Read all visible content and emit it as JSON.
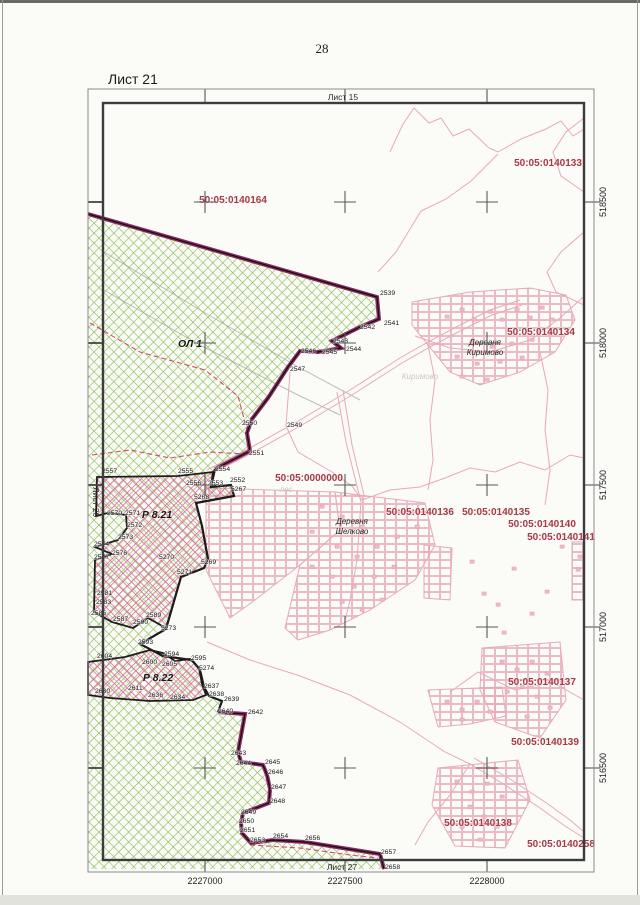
{
  "page": {
    "number": "28",
    "sheet_title": "Лист 21"
  },
  "frame": {
    "top_label": "Лист 15",
    "left_label": "Лист 20",
    "bottom_label": "Лист 27"
  },
  "colors": {
    "cadastral_red": "#a63a45",
    "topo_pink": "#e8a9b8",
    "building_pink": "#efb9c8",
    "green_hatch": "#86bb50",
    "maroon_border": "#8c2862",
    "pink_zone": "#dd5f9b",
    "black_border": "#1c1c1c",
    "gray_line": "#bdbdbd",
    "dash_red": "#d8486e"
  },
  "grid": {
    "x_labels": [
      {
        "text": "2227000",
        "x": 205
      },
      {
        "text": "2227500",
        "x": 345
      },
      {
        "text": "2228000",
        "x": 487
      }
    ],
    "y_labels": [
      {
        "text": "518500",
        "y": 202
      },
      {
        "text": "518000",
        "y": 343
      },
      {
        "text": "517500",
        "y": 485
      },
      {
        "text": "517000",
        "y": 627
      },
      {
        "text": "516500",
        "y": 768
      }
    ],
    "cross_xs": [
      205,
      345,
      487
    ],
    "cross_ys": [
      202,
      343,
      485,
      627,
      768
    ]
  },
  "cadastral_labels": [
    {
      "text": "50:05:0140133",
      "x": 548,
      "y": 166
    },
    {
      "text": "50:05:0140164",
      "x": 233,
      "y": 203
    },
    {
      "text": "50:05:0140134",
      "x": 541,
      "y": 335
    },
    {
      "text": "50:05:0000000",
      "x": 309,
      "y": 481
    },
    {
      "text": "50:05:0140136",
      "x": 420,
      "y": 515
    },
    {
      "text": "50:05:0140135",
      "x": 496,
      "y": 515
    },
    {
      "text": "50:05:0140140",
      "x": 542,
      "y": 527
    },
    {
      "text": "50:05:0140141",
      "x": 561,
      "y": 540
    },
    {
      "text": "50:05:0140137",
      "x": 542,
      "y": 685
    },
    {
      "text": "50:05:0140139",
      "x": 545,
      "y": 745
    },
    {
      "text": "50:05:0140138",
      "x": 478,
      "y": 826
    },
    {
      "text": "50:05:0140258",
      "x": 561,
      "y": 847
    }
  ],
  "village_labels": [
    {
      "line1": "Деревня",
      "line2": "Киримово",
      "x": 485,
      "y": 345
    },
    {
      "line1": "Деревня",
      "line2": "Шелково",
      "x": 352,
      "y": 524
    }
  ],
  "ghost_labels": [
    {
      "text": "Киримово",
      "x": 420,
      "y": 379
    },
    {
      "text": "лес",
      "x": 286,
      "y": 492
    }
  ],
  "zone_labels": [
    {
      "text": "ОЛ 1",
      "x": 190,
      "y": 347
    },
    {
      "text": "Р 8.21",
      "x": 157,
      "y": 518
    },
    {
      "text": "Р 8.22",
      "x": 158,
      "y": 681
    }
  ],
  "points": [
    {
      "n": "2539",
      "x": 380,
      "y": 295
    },
    {
      "n": "2541",
      "x": 384,
      "y": 325
    },
    {
      "n": "2542",
      "x": 360,
      "y": 329
    },
    {
      "n": "2543",
      "x": 333,
      "y": 343
    },
    {
      "n": "2544",
      "x": 346,
      "y": 351
    },
    {
      "n": "2545",
      "x": 322,
      "y": 354
    },
    {
      "n": "2546",
      "x": 301,
      "y": 353
    },
    {
      "n": "2547",
      "x": 290,
      "y": 371
    },
    {
      "n": "2550",
      "x": 242,
      "y": 425
    },
    {
      "n": "2549",
      "x": 287,
      "y": 427
    },
    {
      "n": "2551",
      "x": 249,
      "y": 455
    },
    {
      "n": "2557",
      "x": 102,
      "y": 473
    },
    {
      "n": "2555",
      "x": 178,
      "y": 473
    },
    {
      "n": "2554",
      "x": 215,
      "y": 471
    },
    {
      "n": "2556",
      "x": 186,
      "y": 485
    },
    {
      "n": "2553",
      "x": 208,
      "y": 485
    },
    {
      "n": "2552",
      "x": 230,
      "y": 482
    },
    {
      "n": "5267",
      "x": 231,
      "y": 491
    },
    {
      "n": "5268",
      "x": 194,
      "y": 499
    },
    {
      "n": "2570",
      "x": 107,
      "y": 515
    },
    {
      "n": "2571",
      "x": 125,
      "y": 515
    },
    {
      "n": "2572",
      "x": 127,
      "y": 527
    },
    {
      "n": "2573",
      "x": 118,
      "y": 539
    },
    {
      "n": "2574",
      "x": 94,
      "y": 546
    },
    {
      "n": "2576",
      "x": 112,
      "y": 555
    },
    {
      "n": "2577",
      "x": 94,
      "y": 559
    },
    {
      "n": "5270",
      "x": 159,
      "y": 559
    },
    {
      "n": "5269",
      "x": 201,
      "y": 564
    },
    {
      "n": "5271",
      "x": 177,
      "y": 574
    },
    {
      "n": "2581",
      "x": 97,
      "y": 595
    },
    {
      "n": "2583",
      "x": 96,
      "y": 604
    },
    {
      "n": "2585",
      "x": 91,
      "y": 615
    },
    {
      "n": "2587",
      "x": 113,
      "y": 621
    },
    {
      "n": "2589",
      "x": 146,
      "y": 617
    },
    {
      "n": "2590",
      "x": 133,
      "y": 624
    },
    {
      "n": "5273",
      "x": 161,
      "y": 630
    },
    {
      "n": "2593",
      "x": 138,
      "y": 644
    },
    {
      "n": "2594",
      "x": 164,
      "y": 656
    },
    {
      "n": "2595",
      "x": 191,
      "y": 660
    },
    {
      "n": "5274",
      "x": 199,
      "y": 670
    },
    {
      "n": "2600",
      "x": 142,
      "y": 664
    },
    {
      "n": "2604",
      "x": 97,
      "y": 658
    },
    {
      "n": "2605",
      "x": 162,
      "y": 666
    },
    {
      "n": "2611",
      "x": 128,
      "y": 690
    },
    {
      "n": "2630",
      "x": 95,
      "y": 693
    },
    {
      "n": "2634",
      "x": 170,
      "y": 699
    },
    {
      "n": "2636",
      "x": 148,
      "y": 697
    },
    {
      "n": "2637",
      "x": 204,
      "y": 688
    },
    {
      "n": "2638",
      "x": 209,
      "y": 696
    },
    {
      "n": "2639",
      "x": 224,
      "y": 701
    },
    {
      "n": "2640",
      "x": 218,
      "y": 713
    },
    {
      "n": "2642",
      "x": 248,
      "y": 714
    },
    {
      "n": "2643",
      "x": 231,
      "y": 755
    },
    {
      "n": "2644",
      "x": 236,
      "y": 765
    },
    {
      "n": "2645",
      "x": 265,
      "y": 764
    },
    {
      "n": "2646",
      "x": 268,
      "y": 774
    },
    {
      "n": "2647",
      "x": 271,
      "y": 789
    },
    {
      "n": "2648",
      "x": 270,
      "y": 803
    },
    {
      "n": "2649",
      "x": 241,
      "y": 814
    },
    {
      "n": "2650",
      "x": 239,
      "y": 823
    },
    {
      "n": "2651",
      "x": 240,
      "y": 832
    },
    {
      "n": "2653",
      "x": 250,
      "y": 842
    },
    {
      "n": "2654",
      "x": 273,
      "y": 838
    },
    {
      "n": "2656",
      "x": 305,
      "y": 840
    },
    {
      "n": "2657",
      "x": 381,
      "y": 854
    },
    {
      "n": "2658",
      "x": 385,
      "y": 869
    }
  ],
  "map_shapes": {
    "green_area": "88,214 377,297 379,319 360,327 332,341 341,348 318,352 300,351 288,367 268,398 252,419 247,433 250,451 215,469 211,487 231,485 234,496 196,503 202,526 208,559 204,568 181,577 166,629 140,644 163,656 192,660 200,670 204,687 209,696 222,701 218,712 245,714 238,752 241,762 263,765 267,775 270,789 269,803 243,813 241,823 242,833 251,843 273,840 305,842 380,854 384,869 88,869",
    "maroon_border_1": "M88,214 L377,297 379,319 360,327 332,341 341,348 318,352 300,351 288,367 268,398 252,419 247,433 250,451 215,469",
    "maroon_border_2": "M218,712 L245,714 238,752 241,762 263,765 267,775 270,789 269,803 243,813 241,823 242,833 251,843 273,840 305,842 380,854 384,869",
    "black_border_mid": "M215,469 L211,487 231,485 234,496 196,503 202,526 208,559 204,568 181,577 166,629 140,644 163,656 192,660 200,670 204,687 209,696 222,701 218,712",
    "zone_821": "97,477 178,476 213,472 211,487 231,485 234,496 196,503 202,526 208,559 204,568 181,577 166,628 148,618 133,628 112,622 94,612 95,560 112,554 95,547 118,540 127,528 126,515 108,513 96,516",
    "zone_822": "88,662 125,657 150,650 163,653 175,661 190,659 199,668 202,684 206,695 193,700 150,701 110,698 88,695",
    "parcel_blocks": [
      "206,488 335,492 340,530 300,565 255,600 230,618 206,570",
      "335,492 425,503 435,545 415,580 370,610 330,630 298,640 285,628 300,565 340,530",
      "412,302 470,292 530,288 566,295 575,320 555,352 520,372 480,385 450,372 428,345 412,325",
      "482,648 560,642 566,700 540,738 495,722 480,690",
      "438,768 518,760 530,800 505,848 455,846 432,805",
      "428,690 502,687 506,716 470,724 438,727",
      "572,542 584,542 584,600 572,600",
      "424,545 452,548 450,600 424,598"
    ],
    "topo_lines": [
      "390,152 403,124 414,108 429,123 441,118 453,136 469,129 489,148 498,152 521,139 546,129 561,121 573,136 584,129",
      "498,154 471,181 446,199 421,211 396,252 378,272",
      "584,118 566,132 553,152 561,176 584,192",
      "584,232 561,252 547,272 556,292 584,305",
      "290,372 286,426 298,452 332,472 352,486 362,500",
      "337,392 346,442 356,482 361,502 357,560 350,600 344,625",
      "343,390 352,445 364,495",
      "207,470 250,448 300,420 350,390 400,358 428,342 460,325 490,310 520,300",
      "209,475 252,453 302,425 352,395 402,363 430,347 462,330 492,315 522,305",
      "415,336 450,348 490,352 530,340 560,318 580,300 584,296",
      "207,642 250,660 300,676 350,695 400,722 445,752 470,764 450,795 428,822 415,845",
      "470,764 505,785 540,808 565,826 584,838",
      "474,758 510,779 545,802 570,820 584,832",
      "450,692 478,672 515,690 552,682 584,700",
      "362,500 390,490 420,487 445,478 470,468 495,472 520,462 545,470 570,455 584,458",
      "428,345 435,380 430,420 433,460 428,490",
      "540,352 548,390 545,430 550,470 545,505"
    ],
    "gray_lines": [
      "104,252 200,310 300,368 360,400",
      "104,290 200,345 298,395 340,415"
    ],
    "dashed_lines": [
      "90,323 140,352 205,370 238,396 247,430",
      "92,455 130,450 170,458 210,452 246,454",
      "250,845 300,848 350,855 378,858"
    ],
    "buildings": [
      [
        445,
        315
      ],
      [
        460,
        308
      ],
      [
        472,
        318
      ],
      [
        488,
        310
      ],
      [
        500,
        318
      ],
      [
        515,
        308
      ],
      [
        528,
        316
      ],
      [
        540,
        306
      ],
      [
        550,
        318
      ],
      [
        470,
        340
      ],
      [
        490,
        345
      ],
      [
        510,
        342
      ],
      [
        530,
        338
      ],
      [
        548,
        332
      ],
      [
        455,
        355
      ],
      [
        475,
        362
      ],
      [
        498,
        360
      ],
      [
        520,
        356
      ],
      [
        460,
        375
      ],
      [
        485,
        378
      ],
      [
        320,
        505
      ],
      [
        340,
        515
      ],
      [
        360,
        525
      ],
      [
        310,
        530
      ],
      [
        335,
        545
      ],
      [
        355,
        555
      ],
      [
        375,
        545
      ],
      [
        395,
        535
      ],
      [
        415,
        525
      ],
      [
        310,
        565
      ],
      [
        330,
        575
      ],
      [
        352,
        585
      ],
      [
        372,
        575
      ],
      [
        392,
        565
      ],
      [
        340,
        600
      ],
      [
        360,
        608
      ],
      [
        380,
        598
      ],
      [
        470,
        560
      ],
      [
        482,
        592
      ],
      [
        496,
        603
      ],
      [
        512,
        567
      ],
      [
        530,
        612
      ],
      [
        502,
        631
      ],
      [
        545,
        590
      ],
      [
        560,
        545
      ],
      [
        445,
        700
      ],
      [
        460,
        708
      ],
      [
        475,
        700
      ],
      [
        488,
        710
      ],
      [
        460,
        718
      ],
      [
        500,
        660
      ],
      [
        515,
        668
      ],
      [
        530,
        660
      ],
      [
        545,
        672
      ],
      [
        520,
        685
      ],
      [
        535,
        695
      ],
      [
        505,
        690
      ],
      [
        548,
        706
      ],
      [
        525,
        715
      ],
      [
        455,
        780
      ],
      [
        470,
        790
      ],
      [
        485,
        782
      ],
      [
        500,
        795
      ],
      [
        468,
        805
      ],
      [
        482,
        815
      ],
      [
        460,
        825
      ],
      [
        495,
        825
      ],
      [
        478,
        838
      ],
      [
        578,
        555
      ],
      [
        576,
        568
      ]
    ]
  }
}
